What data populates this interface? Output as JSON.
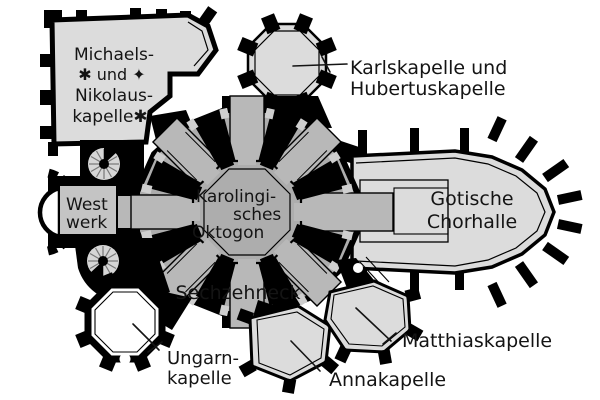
{
  "colors": {
    "background": "#ffffff",
    "wall": "#000000",
    "ambulatory_fill": "#adadad",
    "bay_fill": "#b8b8b8",
    "window_fill": "#cfcfcf",
    "chapel_fill": "#dcdcdc",
    "westwerk_fill": "#c4c4c4",
    "ungarn_fill": "#ffffff",
    "label_color": "#141414"
  },
  "labels": {
    "michaels": {
      "lines": [
        "Michaels-",
        "✱ und ✦",
        "Nikolaus-",
        "kapelle✱"
      ]
    },
    "karls": {
      "lines": [
        "Karlskapelle und",
        "Hubertuskapelle"
      ]
    },
    "westwerk": {
      "lines": [
        "West",
        "werk"
      ]
    },
    "oktogon": {
      "lines": [
        "Karolingi-",
        "sches",
        "Oktogon"
      ]
    },
    "chorhalle": {
      "lines": [
        "Gotische",
        "Chorhalle"
      ]
    },
    "sechzehneck": {
      "text": "Sechzehneck"
    },
    "ungarn": {
      "lines": [
        "Ungarn-",
        "kapelle"
      ]
    },
    "anna": {
      "text": "Annakapelle"
    },
    "matthias": {
      "text": "Matthiaskapelle"
    }
  }
}
